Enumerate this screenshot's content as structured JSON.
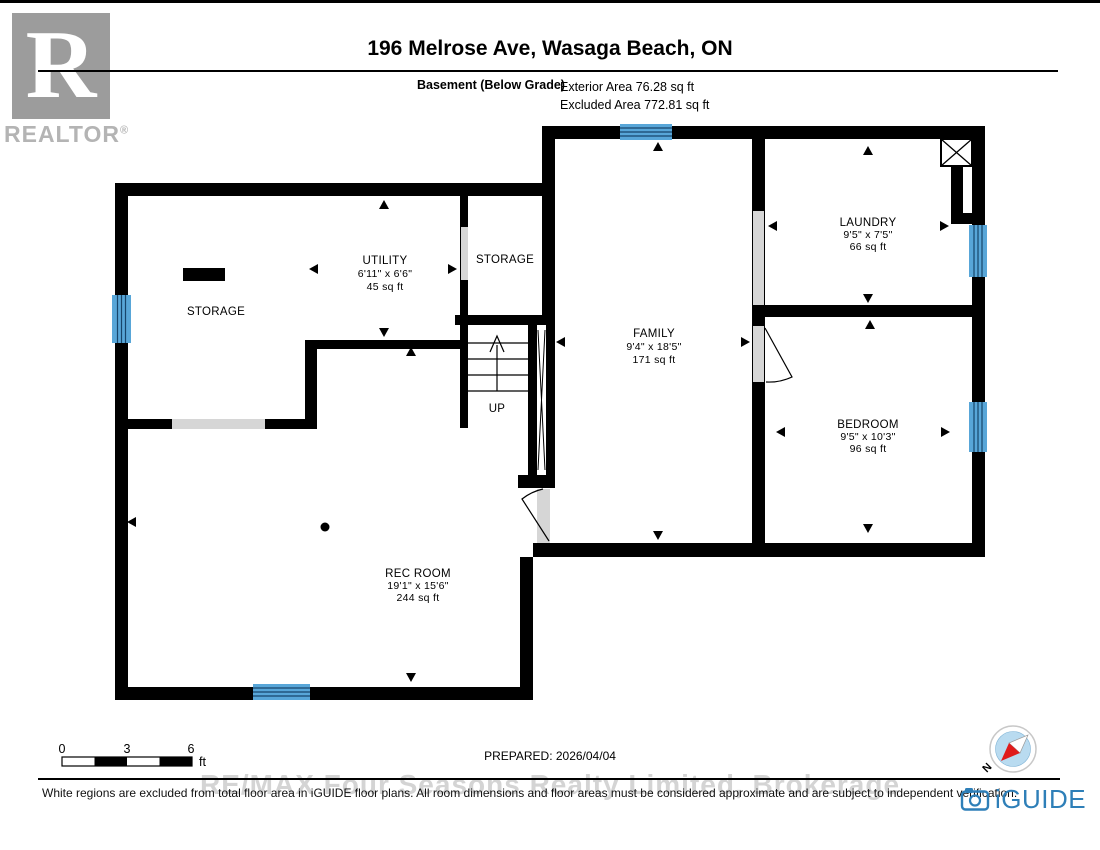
{
  "header": {
    "title": "196 Melrose Ave, Wasaga Beach, ON",
    "floor_label": "Basement (Below Grade)",
    "exterior_area": "Exterior Area 76.28 sq ft",
    "excluded_area": "Excluded Area 772.81 sq ft"
  },
  "branding": {
    "realtor_r": "R",
    "realtor_text": "REALTOR",
    "registered": "®",
    "iguide_text": "iGUIDE",
    "watermark": "RE/MAX Four Seasons Realty Limited, Brokerage"
  },
  "rooms": [
    {
      "name": "STORAGE",
      "dims": "",
      "area": ""
    },
    {
      "name": "UTILITY",
      "dims": "6'11\" x 6'6\"",
      "area": "45 sq ft"
    },
    {
      "name": "STORAGE",
      "dims": "",
      "area": ""
    },
    {
      "name": "FAMILY",
      "dims": "9'4\" x 18'5\"",
      "area": "171 sq ft"
    },
    {
      "name": "LAUNDRY",
      "dims": "9'5\" x 7'5\"",
      "area": "66 sq ft"
    },
    {
      "name": "BEDROOM",
      "dims": "9'5\" x 10'3\"",
      "area": "96 sq ft"
    },
    {
      "name": "REC ROOM",
      "dims": "19'1\" x 15'6\"",
      "area": "244 sq ft"
    }
  ],
  "stairs": {
    "label": "UP"
  },
  "compass": {
    "north_label": "N"
  },
  "scale_bar": {
    "zero": "0",
    "three": "3",
    "six": "6",
    "unit": "ft"
  },
  "prepared": "PREPARED: 2026/04/04",
  "footer": {
    "disclaimer": "White regions are excluded from total floor area in iGUIDE floor plans. All room dimensions and floor areas must be considered approximate and are subject to independent verification."
  },
  "icons": {
    "iguide_camera": "camera-icon",
    "compass_needle": "compass-north-needle",
    "chimney_marker": "chimney-x-marker"
  },
  "colors": {
    "wall": "#000000",
    "window_blue": "#58a6d8",
    "window_line": "#17456b",
    "opening_gray": "#d6d6d6",
    "iguide_blue": "#2e7fb8",
    "compass_red": "#e01b1b",
    "compass_fill": "#b9dbf0",
    "logo_gray": "#9c9c9c",
    "watermark_gray": "#d4d4d4"
  }
}
